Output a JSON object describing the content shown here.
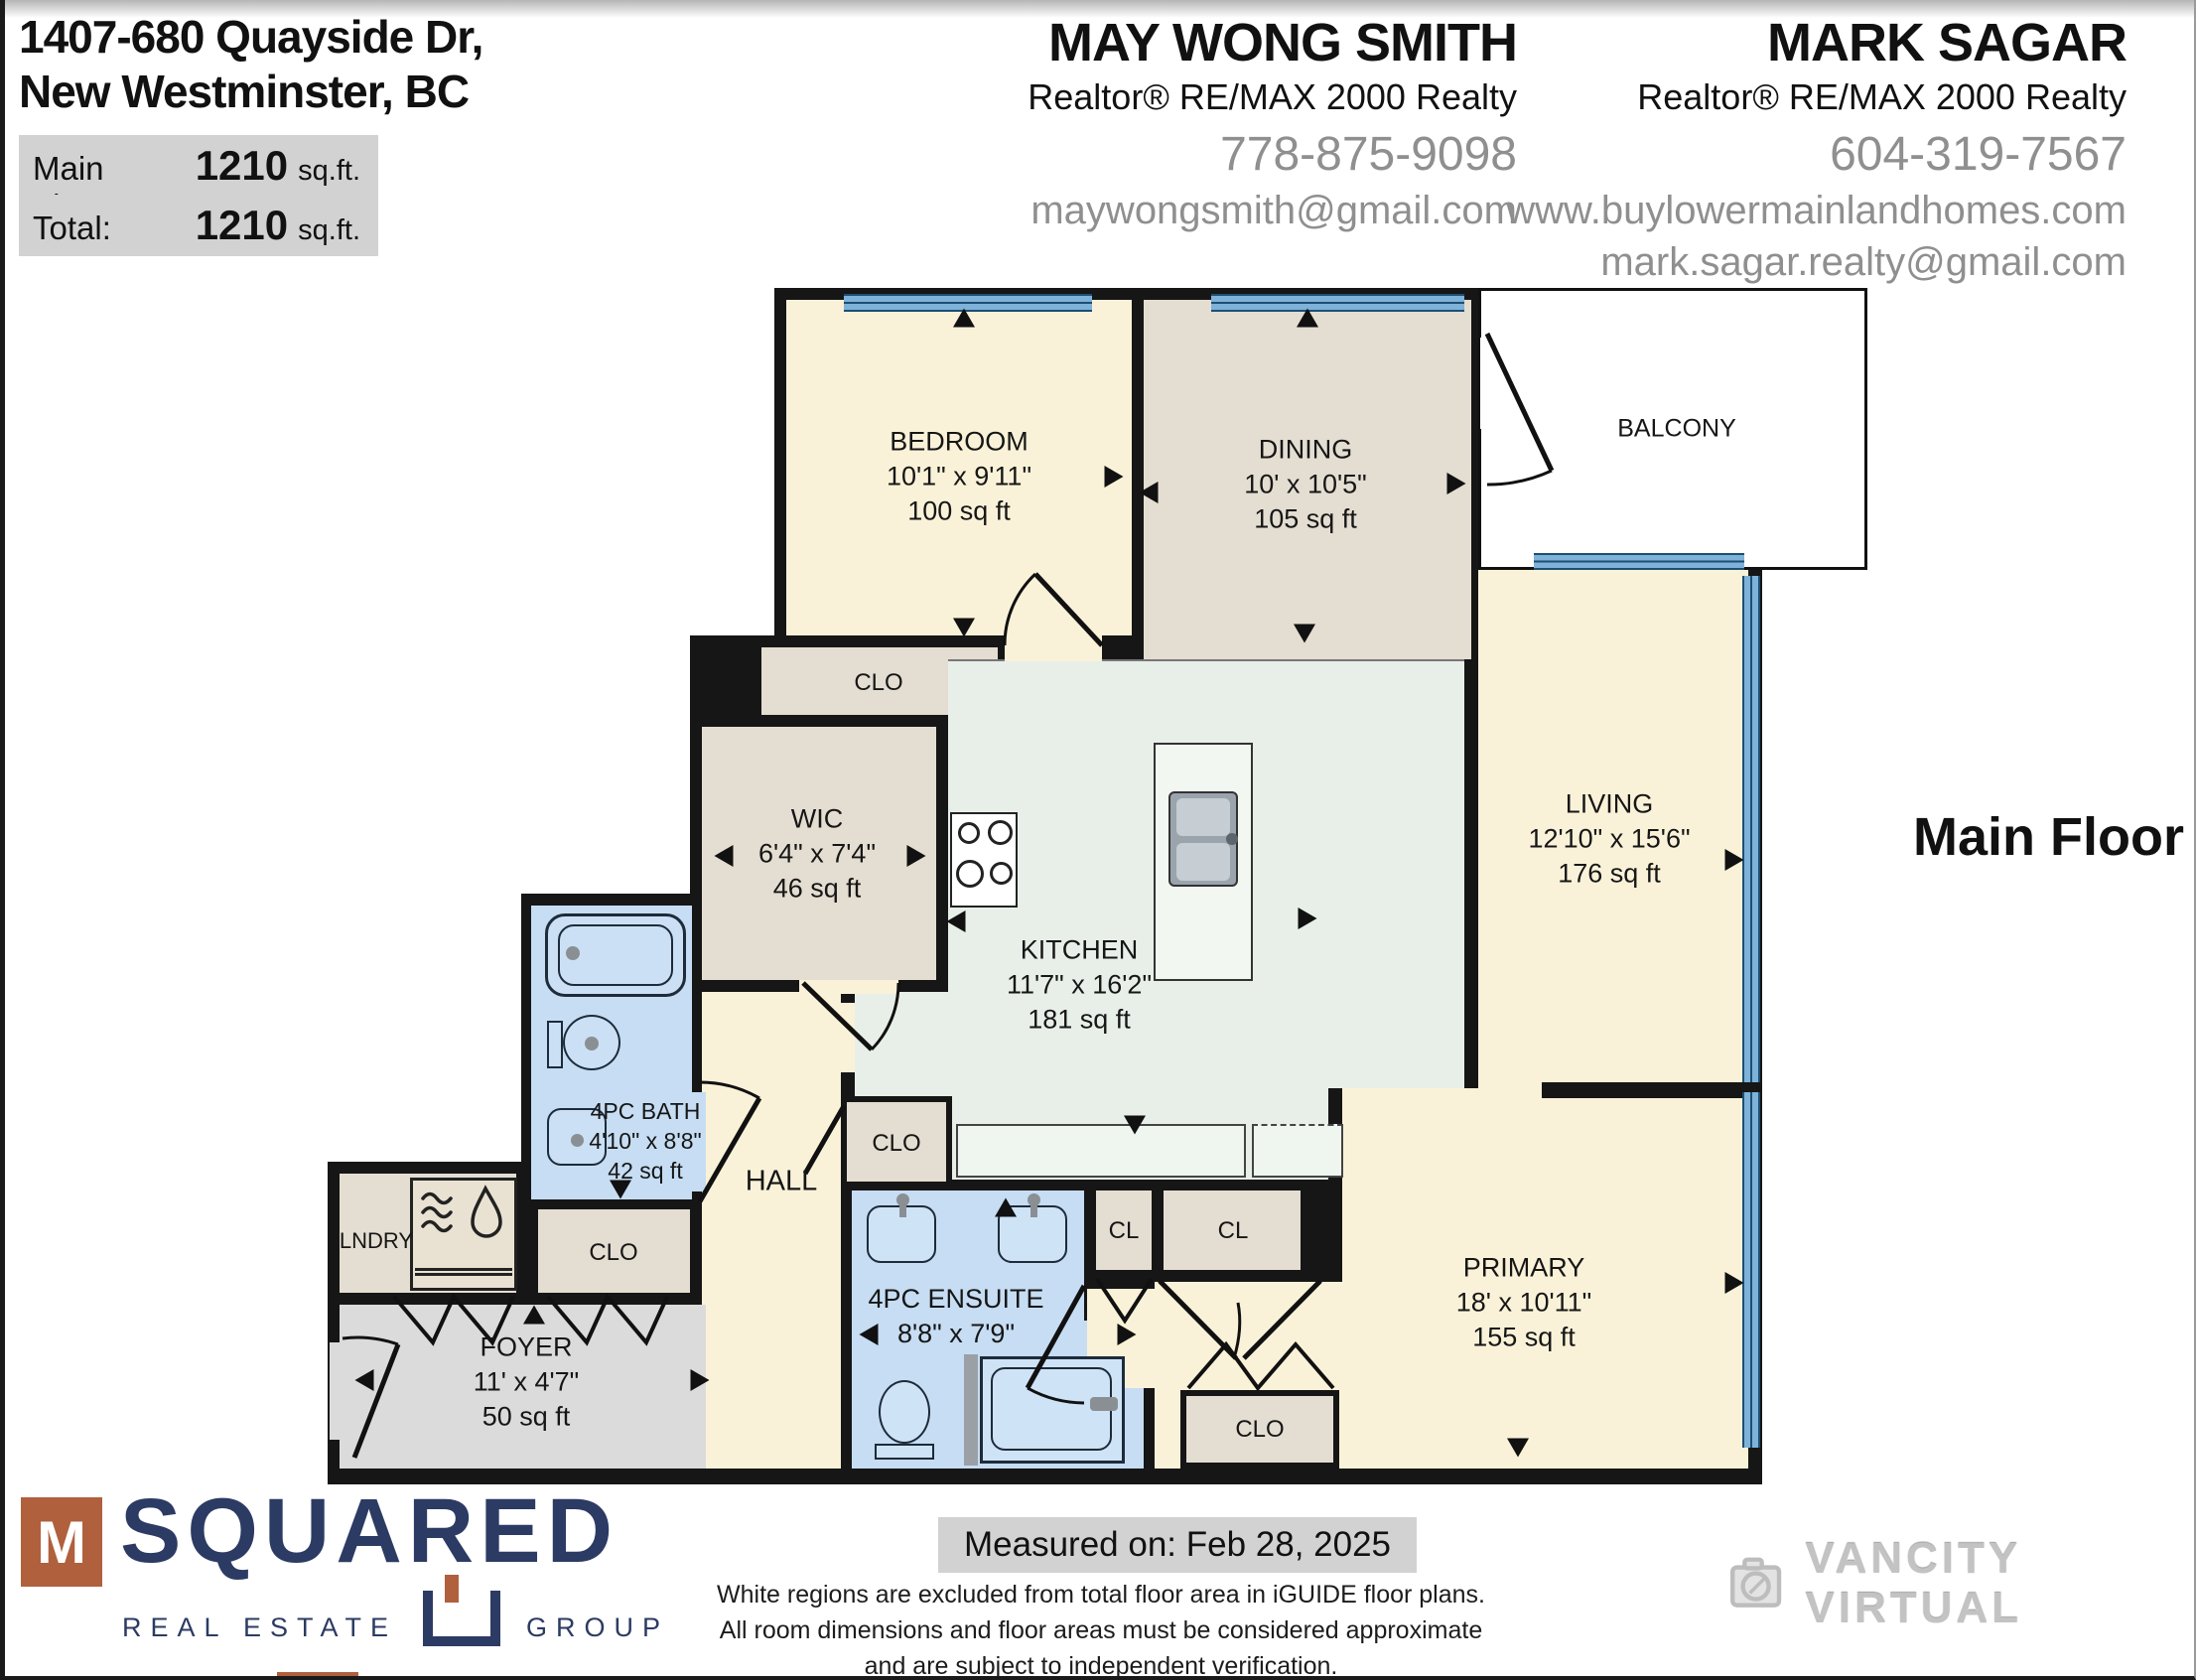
{
  "header": {
    "address_line1": "1407-680 Quayside Dr,",
    "address_line2": "New Westminster, BC",
    "area_rows": [
      {
        "label": "Main Floor:",
        "value": "1210",
        "unit": "sq.ft."
      },
      {
        "label": "Total:",
        "value": "1210",
        "unit": "sq.ft."
      }
    ],
    "agents": [
      {
        "name": "MAY WONG SMITH",
        "title": "Realtor® RE/MAX 2000 Realty",
        "phone": "778-875-9098",
        "email": "maywongsmith@gmail.com"
      },
      {
        "name": "MARK SAGAR",
        "title": "Realtor® RE/MAX 2000 Realty",
        "phone": "604-319-7567",
        "website": "www.buylowermainlandhomes.com",
        "email": "mark.sagar.realty@gmail.com"
      }
    ]
  },
  "plan": {
    "floor_label": "Main Floor",
    "rooms": {
      "bedroom": {
        "name": "BEDROOM",
        "dims": "10'1\" x 9'11\"",
        "area": "100 sq ft"
      },
      "dining": {
        "name": "DINING",
        "dims": "10' x 10'5\"",
        "area": "105 sq ft"
      },
      "balcony": {
        "name": "BALCONY"
      },
      "living": {
        "name": "LIVING",
        "dims": "12'10\" x 15'6\"",
        "area": "176 sq ft"
      },
      "wic": {
        "name": "WIC",
        "dims": "6'4\" x 7'4\"",
        "area": "46 sq ft"
      },
      "kitchen": {
        "name": "KITCHEN",
        "dims": "11'7\" x 16'2\"",
        "area": "181 sq ft"
      },
      "bath": {
        "name": "4PC BATH",
        "dims": "4'10\" x 8'8\"",
        "area": "42 sq ft"
      },
      "hall": {
        "name": "HALL"
      },
      "ensuite": {
        "name": "4PC ENSUITE",
        "dims": "8'8\" x 7'9\""
      },
      "primary": {
        "name": "PRIMARY",
        "dims": "18' x 10'11\"",
        "area": "155 sq ft"
      },
      "foyer": {
        "name": "FOYER",
        "dims": "11' x 4'7\"",
        "area": "50 sq ft"
      },
      "laundry": {
        "name": "LNDRY"
      },
      "clo_bedroom": {
        "name": "CLO"
      },
      "clo_hall": {
        "name": "CLO"
      },
      "clo_foyer": {
        "name": "CLO"
      },
      "clo_primary": {
        "name": "CLO"
      },
      "cl_small": {
        "name": "CL"
      },
      "cl_wide": {
        "name": "CL"
      }
    }
  },
  "footer": {
    "msquared": {
      "m": "M",
      "name": "SQUARED",
      "left": "REAL ESTATE",
      "right": "GROUP"
    },
    "measured_on": "Measured on: Feb 28, 2025",
    "disclaimer": [
      "White regions are excluded from total floor area in iGUIDE floor plans.",
      "All room dimensions and floor areas must be considered approximate",
      "and are subject to independent verification."
    ],
    "vancity": "VANCITY VIRTUAL"
  },
  "colors": {
    "wall": "#161616",
    "window_blue": "#7FB2D9",
    "room_cream": "#FAF2D8",
    "room_tan": "#E4DDD1",
    "room_mint": "#E7EFE8",
    "room_bath_blue": "#C6DDF3",
    "room_foyer_gray": "#DBDBDB",
    "label_bg_gray": "#D2D2D2",
    "contact_gray_text": "#8F8F8F",
    "logo_navy": "#2C3B63",
    "logo_rust": "#B0603D"
  }
}
